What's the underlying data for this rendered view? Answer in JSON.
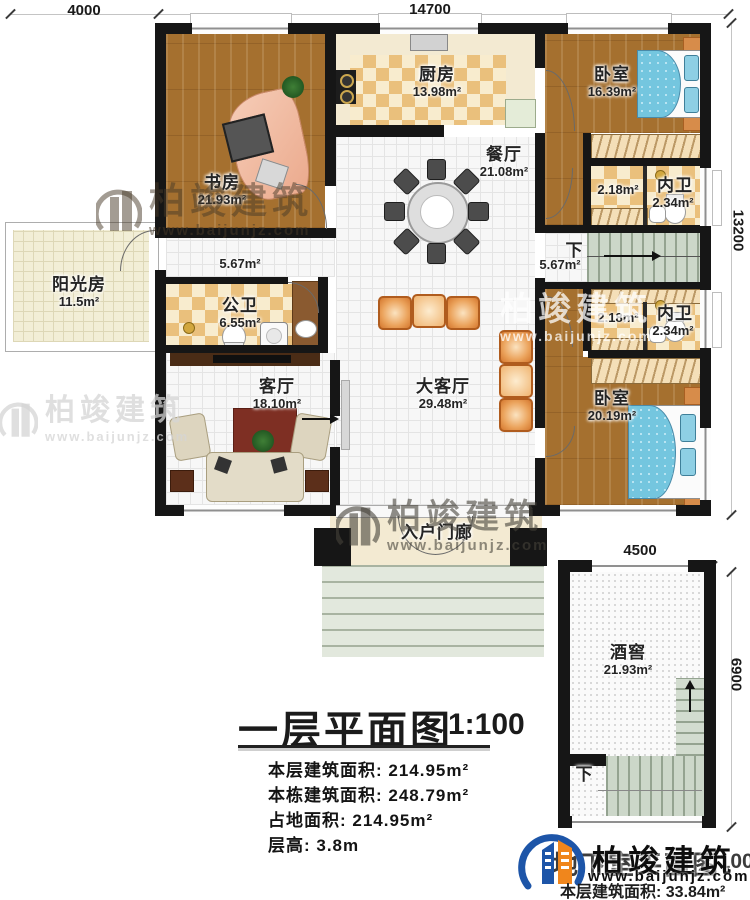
{
  "brand": {
    "name": "柏竣建筑",
    "url": "www.baijunjz.com"
  },
  "dims": {
    "top_left": "4000",
    "top_main": "14700",
    "right_main": "13200",
    "cellar_top": "4500",
    "cellar_right": "6900"
  },
  "rooms": {
    "study": {
      "name": "书房",
      "area": "21.93m²"
    },
    "kitchen": {
      "name": "厨房",
      "area": "13.98m²"
    },
    "bedroom_top": {
      "name": "卧室",
      "area": "16.39m²"
    },
    "dining": {
      "name": "餐厅",
      "area": "21.08m²"
    },
    "sunroom": {
      "name": "阳光房",
      "area": "11.5m²"
    },
    "public_bath": {
      "name": "公卫",
      "area": "6.55m²"
    },
    "living": {
      "name": "客厅",
      "area": "18.10m²"
    },
    "great_living": {
      "name": "大客厅",
      "area": "29.48m²"
    },
    "bedroom_bottom": {
      "name": "卧室",
      "area": "20.19m²"
    },
    "porch": {
      "name": "入户门廊"
    },
    "cellar": {
      "name": "酒窖",
      "area": "21.93m²"
    }
  },
  "baths": {
    "top": {
      "closet_area": "2.18m²",
      "name": "内卫",
      "area": "2.34m²"
    },
    "bottom": {
      "closet_area": "2.18m²",
      "name": "内卫",
      "area": "2.34m²"
    }
  },
  "stair": {
    "down": "下",
    "area": "5.67m²"
  },
  "hall": {
    "area": "5.67m²"
  },
  "cellar_stair": {
    "down": "下"
  },
  "title_block": {
    "title": "一层平面图",
    "scale": "1:100",
    "stats": [
      "本层建筑面积: 214.95m²",
      "本栋建筑面积: 248.79m²",
      "占地面积: 214.95m²",
      "层高: 3.8m"
    ]
  },
  "basement_block": {
    "title": "地下室平面图",
    "scale": "1:100",
    "stat": "本层建筑面积: 33.84m²"
  }
}
